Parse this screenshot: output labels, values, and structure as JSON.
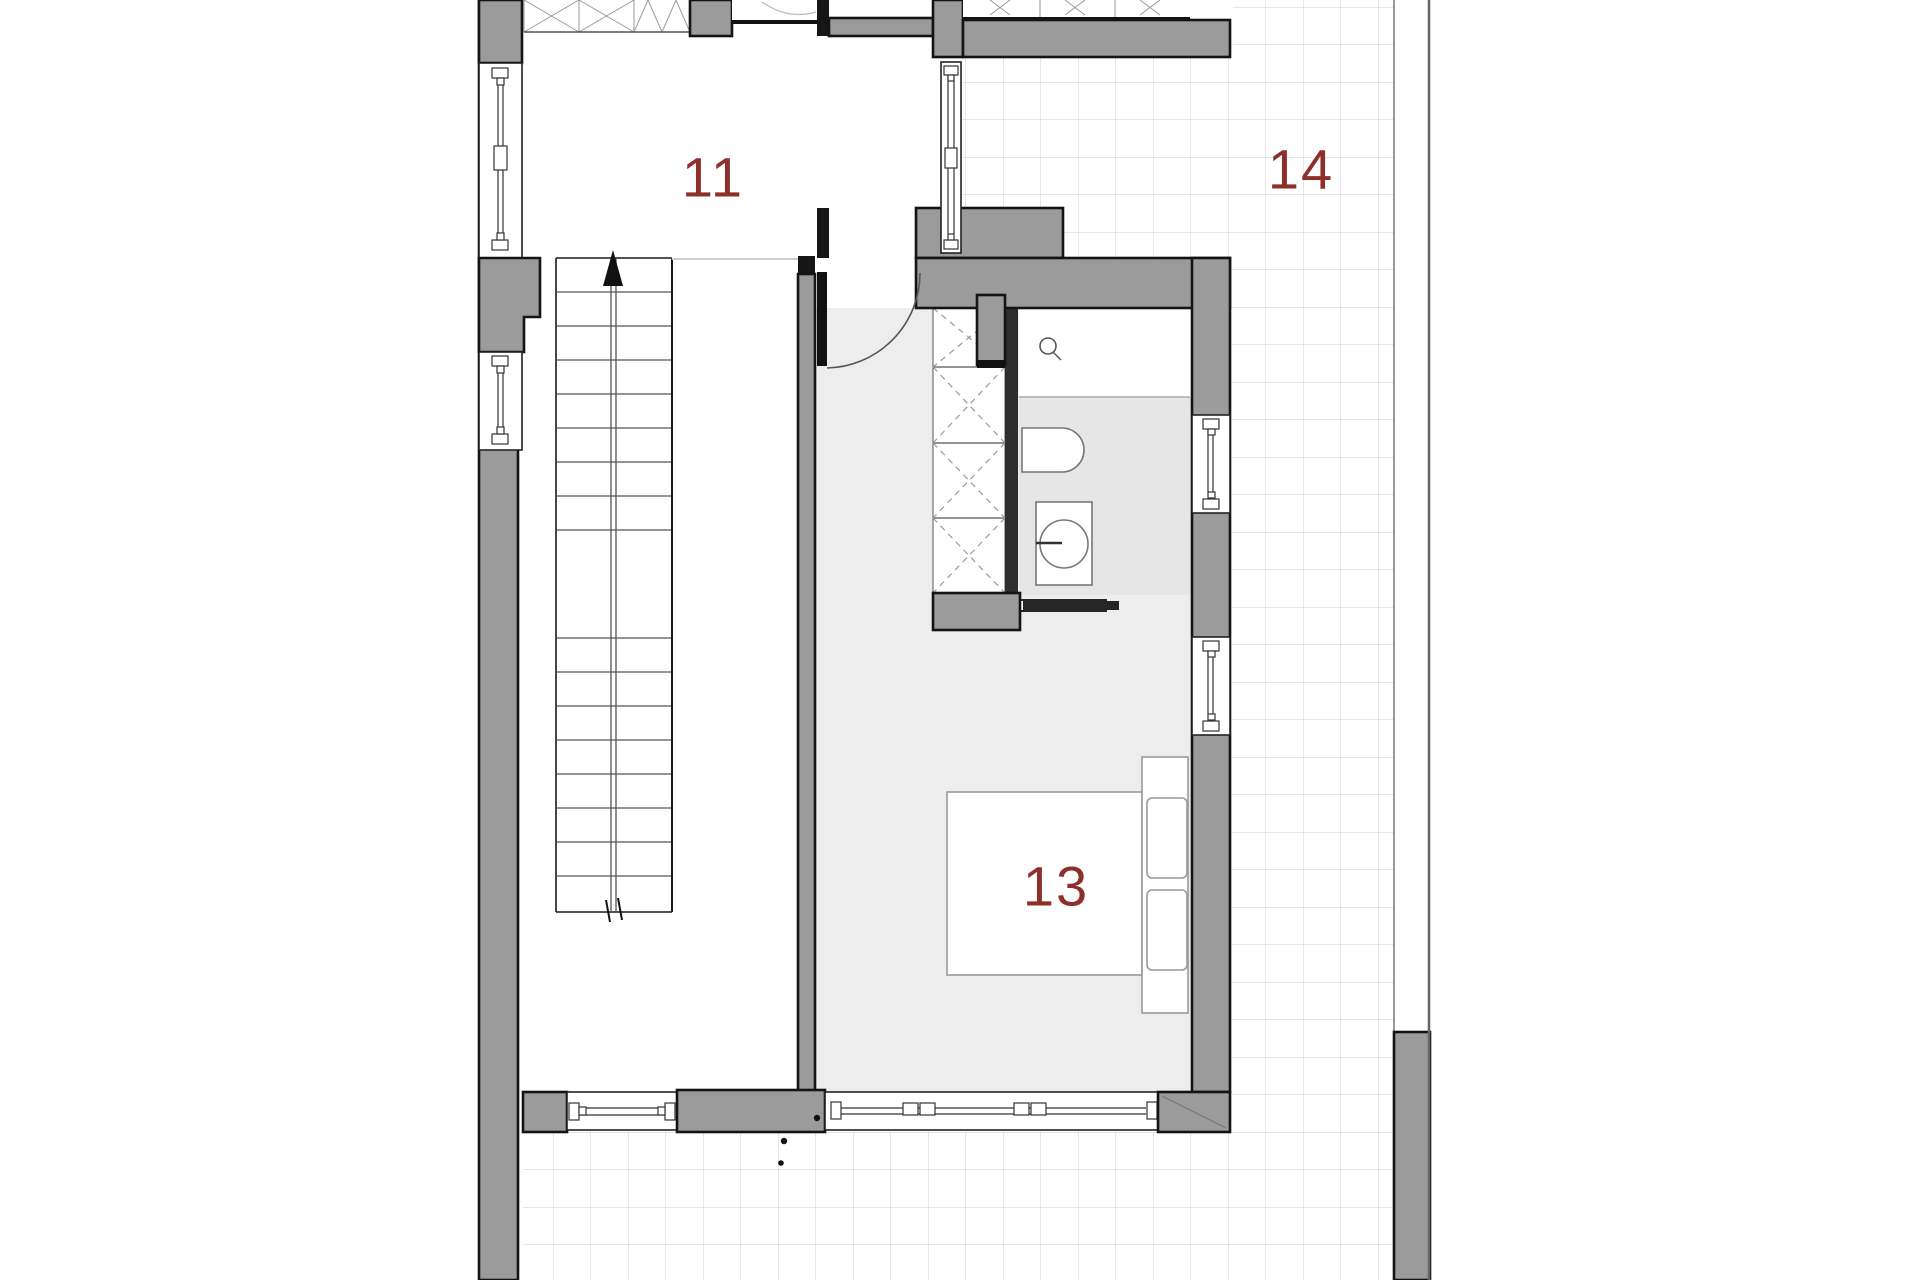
{
  "floor_plan": {
    "room_labels": [
      {
        "id": "room-11",
        "label": "11"
      },
      {
        "id": "room-13",
        "label": "13"
      },
      {
        "id": "room-14",
        "label": "14"
      }
    ],
    "colors": {
      "wall": "#9b9b9b",
      "outline": "#141414",
      "room_label": "#8d2f2a",
      "floor_tint": "#ededed",
      "tile_grid_line": "#cccccc"
    }
  }
}
